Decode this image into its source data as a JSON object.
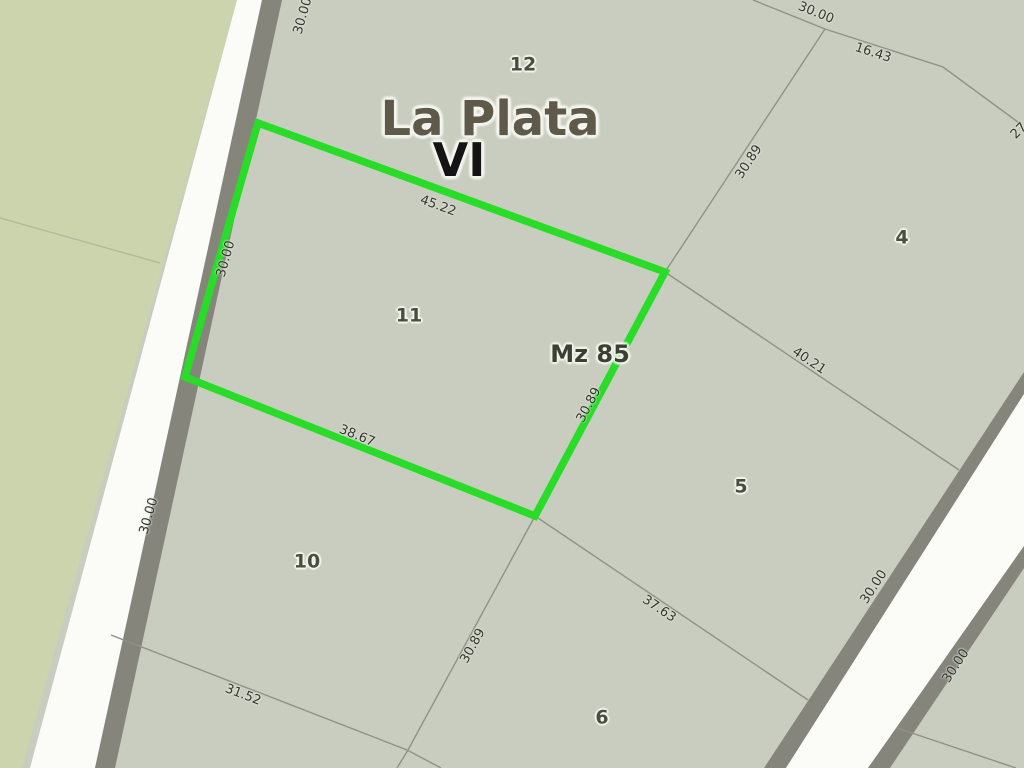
{
  "map": {
    "city_title": "La Plata",
    "section_title": "VI",
    "block_label": "Mz 85",
    "highlighted_parcel": "11",
    "colors": {
      "base_parcel": "#c8cdbf",
      "west_area": "#ccd4ae",
      "road_fill": "#fbfbf8",
      "road_border": "#85857c",
      "boundary_line": "#8f9285",
      "highlight_outline": "#28dc28",
      "label_text": "#33362e"
    },
    "labels": [
      {
        "name": "parcel-number-12",
        "text": "12",
        "x": 523,
        "y": 65,
        "rot": 0,
        "kind": "parcel-number"
      },
      {
        "name": "city-title",
        "text": "La Plata",
        "x": 490,
        "y": 119,
        "rot": 0,
        "kind": "city-title"
      },
      {
        "name": "section-title",
        "text": "VI",
        "x": 459,
        "y": 160,
        "rot": 0,
        "kind": "section-title"
      },
      {
        "name": "parcel-number-11",
        "text": "11",
        "x": 409,
        "y": 316,
        "rot": 0,
        "kind": "parcel-number"
      },
      {
        "name": "block-label-mz85",
        "text": "Mz 85",
        "x": 590,
        "y": 354,
        "rot": 0,
        "kind": "block-label"
      },
      {
        "name": "parcel-number-4",
        "text": "4",
        "x": 902,
        "y": 238,
        "rot": 0,
        "kind": "parcel-number"
      },
      {
        "name": "parcel-number-5",
        "text": "5",
        "x": 741,
        "y": 487,
        "rot": 0,
        "kind": "parcel-number"
      },
      {
        "name": "parcel-number-10",
        "text": "10",
        "x": 307,
        "y": 562,
        "rot": 0,
        "kind": "parcel-number"
      },
      {
        "name": "parcel-number-6",
        "text": "6",
        "x": 602,
        "y": 718,
        "rot": 0,
        "kind": "parcel-number"
      },
      {
        "name": "measure-top-45-22",
        "text": "45.22",
        "x": 438,
        "y": 206,
        "rot": 20,
        "kind": "measurement"
      },
      {
        "name": "measure-bottom-38-67",
        "text": "38.67",
        "x": 357,
        "y": 436,
        "rot": 22,
        "kind": "measurement"
      },
      {
        "name": "measure-right-30-89",
        "text": "30.89",
        "x": 589,
        "y": 405,
        "rot": -62,
        "kind": "measurement"
      },
      {
        "name": "measure-road-30-00-top",
        "text": "30.00",
        "x": 303,
        "y": 16,
        "rot": -74,
        "kind": "measurement"
      },
      {
        "name": "measure-road-30-00-mid",
        "text": "30.00",
        "x": 226,
        "y": 259,
        "rot": -74,
        "kind": "measurement"
      },
      {
        "name": "measure-road-30-00-low",
        "text": "30.00",
        "x": 149,
        "y": 516,
        "rot": -74,
        "kind": "measurement"
      },
      {
        "name": "measure-north-30-00",
        "text": "30.00",
        "x": 816,
        "y": 13,
        "rot": 22,
        "kind": "measurement"
      },
      {
        "name": "measure-north-16-43",
        "text": "16.43",
        "x": 873,
        "y": 53,
        "rot": 18,
        "kind": "measurement"
      },
      {
        "name": "measure-east-30-89",
        "text": "30.89",
        "x": 749,
        "y": 162,
        "rot": -57,
        "kind": "measurement"
      },
      {
        "name": "measure-40-21",
        "text": "40.21",
        "x": 809,
        "y": 361,
        "rot": 34,
        "kind": "measurement"
      },
      {
        "name": "measure-37-63",
        "text": "37.63",
        "x": 659,
        "y": 609,
        "rot": 34,
        "kind": "measurement"
      },
      {
        "name": "measure-31-52",
        "text": "31.52",
        "x": 243,
        "y": 695,
        "rot": 21,
        "kind": "measurement"
      },
      {
        "name": "measure-south-30-89",
        "text": "30.89",
        "x": 473,
        "y": 646,
        "rot": -61,
        "kind": "measurement"
      },
      {
        "name": "measure-rroad-30-00-left",
        "text": "30.00",
        "x": 874,
        "y": 587,
        "rot": -57,
        "kind": "measurement"
      },
      {
        "name": "measure-rroad-30-00-right",
        "text": "30.00",
        "x": 956,
        "y": 666,
        "rot": -57,
        "kind": "measurement"
      },
      {
        "name": "measure-edge-27",
        "text": "27",
        "x": 1019,
        "y": 131,
        "rot": -45,
        "kind": "measurement"
      }
    ]
  }
}
